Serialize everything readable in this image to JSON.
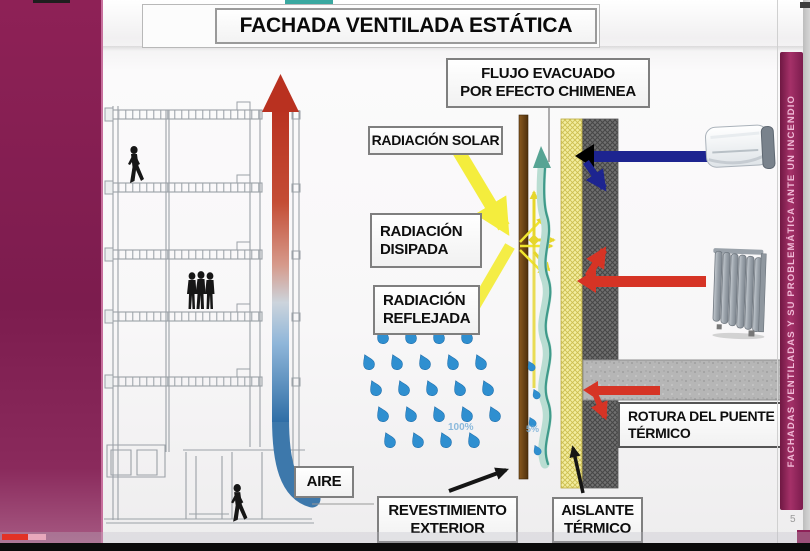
{
  "slide": {
    "title": "FACHADA VENTILADA ESTÁTICA",
    "number": "5"
  },
  "side_banner": {
    "text": "FACHADAS VENTILADAS Y SU PROBLEMÁTICA ANTE UN INCENDIO"
  },
  "callouts": {
    "flujo_evacuado": "FLUJO EVACUADO\nPOR EFECTO CHIMENEA",
    "radiacion_solar": "RADIACIÓN SOLAR",
    "radiacion_disipada": "RADIACIÓN\nDISIPADA",
    "radiacion_reflejada": "RADIACIÓN\nREFLEJADA",
    "aire": "AIRE",
    "revestimiento_exterior": "REVESTIMIENTO\nEXTERIOR",
    "aislante_termico": "AISLANTE\nTÉRMICO",
    "rotura_puente_termico": "ROTURA DEL PUENTE\nTÉRMICO"
  },
  "annotations": {
    "rain_outside_pct": "100%",
    "rain_cavity_pct": "5%"
  },
  "colors": {
    "frame_magenta": "#862052",
    "banner_text_pink": "#efb9d6",
    "hot_red": "#b93120",
    "cold_blue": "#2f6ea6",
    "heat_arrow_red": "#d63425",
    "ac_arrow_navy": "#1d2490",
    "sun_yellow": "#f4ed3d",
    "cavity_teal": "#3f9a8a",
    "rain_blue": "#2f8fd0",
    "cladding_brown": "#6b4413",
    "insulation_yellow": "#f3eda0",
    "wall_gray": "#707070",
    "slab_gray": "#b6b6b6",
    "progress_red": "#e23226"
  }
}
